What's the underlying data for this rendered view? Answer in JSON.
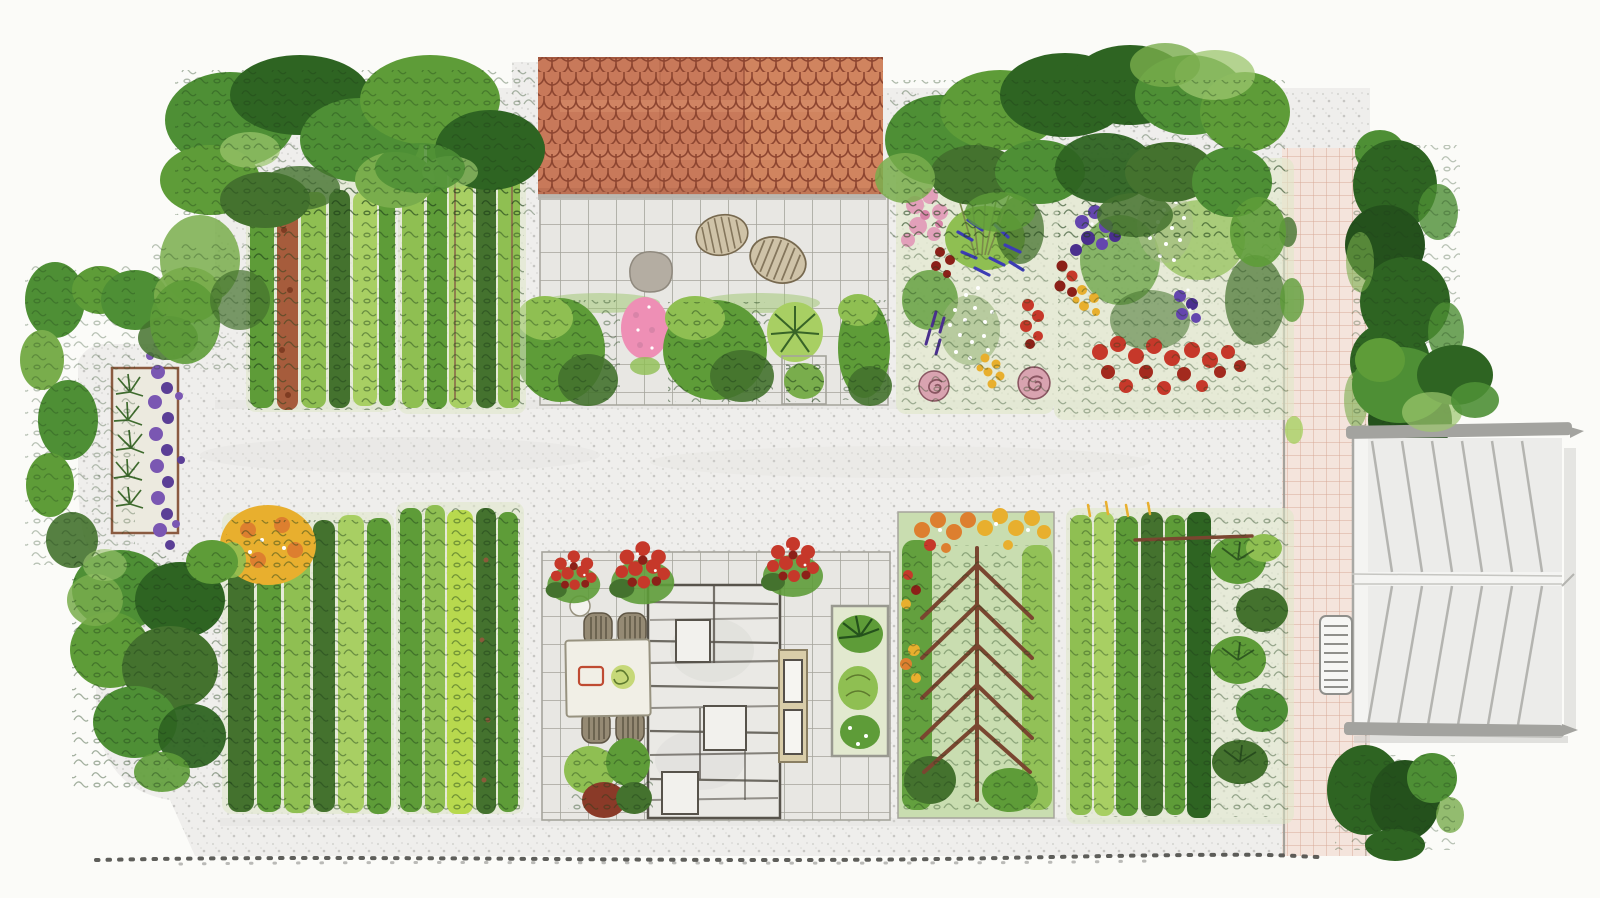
{
  "scene": {
    "type": "watercolor-garden-plan",
    "view": "top-down",
    "palette": {
      "paper": "#fbfbf8",
      "gravel": "#efeeec",
      "speckle_a": "#d4d4d0",
      "speckle_b": "#c2c2be",
      "wash_shadow": "#dcdcd8",
      "roof_tile": "#c8795a",
      "roof_tile_light": "#d0845f",
      "roof_outline": "#8d4530",
      "fascia": "#b8b6af",
      "tile_fill": "#e8e7e3",
      "tile_line": "#a5a49b",
      "slab_fill": "#eae9e5",
      "slab_line": "#57534b",
      "pink_path": "#f4e4dc",
      "pink_grid": "#cf9680",
      "path_edge": "#9d9d96",
      "hedge_dark": "#2e6422",
      "hedge_deep": "#24511c",
      "hedge_mid": "#4e8f35",
      "hedge_light": "#79ad4c",
      "hedge_pale": "#9cc66e",
      "leaf_green": "#5e9c38",
      "leaf_light": "#8fbf52",
      "leaf_yellow": "#a8cf63",
      "leaf_bright": "#b8d94e",
      "leaf_deep": "#44722e",
      "ink": "#1c3d17",
      "soil_red": "#a65c3c",
      "trellis": "#7a4630",
      "lavender": "#7a57b2",
      "lavender_dark": "#5b3f96",
      "rosemary": "#3f6b2e",
      "pink_flower": "#ee8fb5",
      "rose_pink": "#e2a0ba",
      "rose_mauve": "#d9a3b0",
      "rose_line": "#8a5662",
      "red_flower": "#c6382a",
      "red_dark": "#8c2018",
      "orange_flower": "#dd7f2f",
      "yellow_flower": "#e8af2e",
      "blue_flower": "#3c3cb4",
      "purple_flower": "#6446ae",
      "purple_dark": "#4a2f8e",
      "white_flower": "#ffffff",
      "allium": "#9a9560",
      "stone": "#b4ada2",
      "stool": "#cfc3a8",
      "stool_line": "#77694f",
      "table": "#f1efe6",
      "table_line": "#97927f",
      "chair": "#958a74",
      "chair_line": "#5e5544",
      "placemat": "#bf4b32",
      "plate": "#c6d878",
      "door": "#d9cda9",
      "door_line": "#55504a",
      "planter": "#e2e9cf",
      "structure_fill": "#ececea",
      "structure_line": "#b4b4b0",
      "structure_bar": "#a3a39f",
      "shadow": "#cfcfcb",
      "bed_wash": "#dfe8c8",
      "trellis_wash": "#c9ddb0",
      "dot": "#42423e"
    },
    "regions": [
      "gravel-ground",
      "house-roof",
      "upper-terrace",
      "shrub-border-row",
      "veg-bed-top-left-1",
      "veg-bed-top-left-2",
      "flower-bed-left",
      "flower-bed-right",
      "lavender-raised-bed",
      "left-hedge",
      "top-left-tree-canopy",
      "top-right-tree-canopy",
      "cypress-hedge",
      "pink-grid-path",
      "garden-shed-roof",
      "bench",
      "dining-patio",
      "slab-building",
      "entrance-door",
      "dining-table",
      "veg-bed-bottom-1",
      "veg-bed-bottom-2",
      "espalier-trellis-bed",
      "veg-bed-bottom-wide",
      "planter-box",
      "boundary-dotted-line",
      "bush-top-of-shed",
      "bush-below-shed"
    ]
  }
}
